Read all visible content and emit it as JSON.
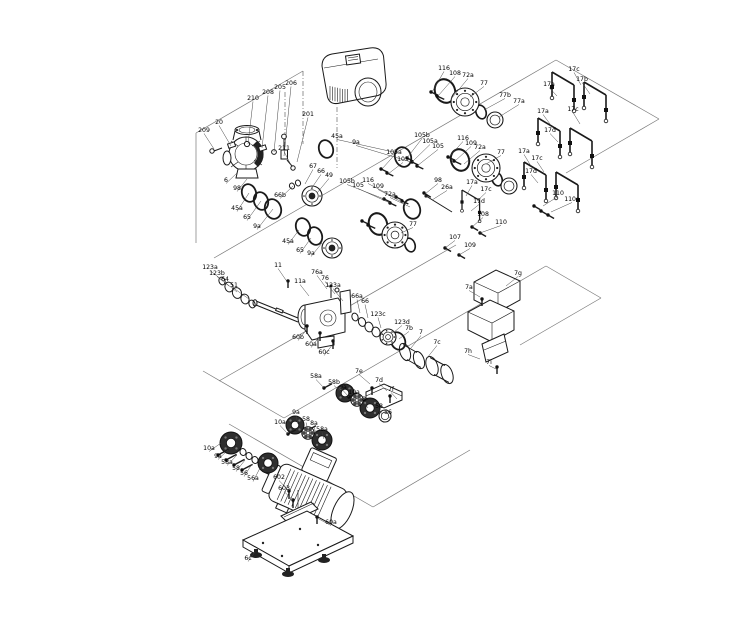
{
  "diagram": {
    "background": "#ffffff",
    "line_color": "#1a1a1a",
    "label_color": "#000000",
    "callouts": [
      {
        "label": "209",
        "x": 204,
        "y": 132,
        "px": 214,
        "py": 149
      },
      {
        "label": "20",
        "x": 219,
        "y": 124,
        "px": 231,
        "py": 146
      },
      {
        "label": "210",
        "x": 253,
        "y": 100,
        "px": 248,
        "py": 144
      },
      {
        "label": "208",
        "x": 268,
        "y": 94,
        "px": 262,
        "py": 148
      },
      {
        "label": "205",
        "x": 280,
        "y": 89,
        "px": 274,
        "py": 152
      },
      {
        "label": "206",
        "x": 291,
        "y": 85,
        "px": 284,
        "py": 156
      },
      {
        "label": "201",
        "x": 308,
        "y": 116,
        "px": 297,
        "py": 162
      },
      {
        "label": "211",
        "x": 284,
        "y": 150,
        "px": 292,
        "py": 167
      },
      {
        "label": "6",
        "x": 226,
        "y": 182,
        "px": 237,
        "py": 173
      },
      {
        "label": "98",
        "x": 237,
        "y": 190,
        "px": 247,
        "py": 179
      },
      {
        "label": "66b",
        "x": 280,
        "y": 197,
        "px": 293,
        "py": 186
      },
      {
        "label": "45a",
        "x": 237,
        "y": 210,
        "px": 249,
        "py": 193
      },
      {
        "label": "65",
        "x": 247,
        "y": 219,
        "px": 261,
        "py": 201
      },
      {
        "label": "9a",
        "x": 257,
        "y": 228,
        "px": 273,
        "py": 209
      },
      {
        "label": "67",
        "x": 313,
        "y": 168,
        "px": 305,
        "py": 184
      },
      {
        "label": "66",
        "x": 321,
        "y": 173,
        "px": 311,
        "py": 189
      },
      {
        "label": "49",
        "x": 329,
        "y": 177,
        "px": 317,
        "py": 193
      },
      {
        "label": "45a",
        "x": 337,
        "y": 138,
        "px": 398,
        "py": 153
      },
      {
        "label": "9a",
        "x": 356,
        "y": 144,
        "px": 411,
        "py": 162
      },
      {
        "label": "116",
        "x": 444,
        "y": 70,
        "px": 432,
        "py": 92
      },
      {
        "label": "108",
        "x": 455,
        "y": 75,
        "px": 438,
        "py": 96
      },
      {
        "label": "72a",
        "x": 468,
        "y": 77,
        "px": 451,
        "py": 99
      },
      {
        "label": "77",
        "x": 484,
        "y": 85,
        "px": 470,
        "py": 97
      },
      {
        "label": "77b",
        "x": 505,
        "y": 97,
        "px": 484,
        "py": 110
      },
      {
        "label": "77a",
        "x": 519,
        "y": 103,
        "px": 499,
        "py": 117
      },
      {
        "label": "17c",
        "x": 574,
        "y": 71,
        "px": 581,
        "py": 85
      },
      {
        "label": "17b",
        "x": 582,
        "y": 81,
        "px": 590,
        "py": 94
      },
      {
        "label": "17a",
        "x": 549,
        "y": 86,
        "px": 557,
        "py": 96
      },
      {
        "label": "105b",
        "x": 422,
        "y": 137,
        "px": 407,
        "py": 158
      },
      {
        "label": "105a",
        "x": 430,
        "y": 143,
        "px": 412,
        "py": 162
      },
      {
        "label": "105",
        "x": 438,
        "y": 148,
        "px": 417,
        "py": 166
      },
      {
        "label": "105a",
        "x": 394,
        "y": 154,
        "px": 382,
        "py": 169
      },
      {
        "label": "105",
        "x": 403,
        "y": 161,
        "px": 388,
        "py": 174
      },
      {
        "label": "116",
        "x": 463,
        "y": 140,
        "px": 449,
        "py": 157
      },
      {
        "label": "109",
        "x": 471,
        "y": 145,
        "px": 455,
        "py": 161
      },
      {
        "label": "72a",
        "x": 480,
        "y": 149,
        "px": 464,
        "py": 164
      },
      {
        "label": "77",
        "x": 501,
        "y": 154,
        "px": 486,
        "py": 164
      },
      {
        "label": "17a",
        "x": 543,
        "y": 113,
        "px": 550,
        "py": 124
      },
      {
        "label": "17c",
        "x": 573,
        "y": 111,
        "px": 580,
        "py": 124
      },
      {
        "label": "17d",
        "x": 550,
        "y": 132,
        "px": 558,
        "py": 142
      },
      {
        "label": "110",
        "x": 558,
        "y": 195,
        "px": 543,
        "py": 206
      },
      {
        "label": "110a",
        "x": 572,
        "y": 201,
        "px": 551,
        "py": 212
      },
      {
        "label": "45a",
        "x": 288,
        "y": 243,
        "px": 299,
        "py": 230
      },
      {
        "label": "65",
        "x": 300,
        "y": 252,
        "px": 311,
        "py": 238
      },
      {
        "label": "9a",
        "x": 311,
        "y": 255,
        "px": 322,
        "py": 243
      },
      {
        "label": "105b",
        "x": 347,
        "y": 183,
        "px": 384,
        "py": 199
      },
      {
        "label": "105",
        "x": 358,
        "y": 187,
        "px": 390,
        "py": 203
      },
      {
        "label": "116",
        "x": 368,
        "y": 182,
        "px": 396,
        "py": 198
      },
      {
        "label": "109",
        "x": 378,
        "y": 188,
        "px": 402,
        "py": 202
      },
      {
        "label": "72a",
        "x": 390,
        "y": 196,
        "px": 410,
        "py": 207
      },
      {
        "label": "77",
        "x": 413,
        "y": 226,
        "px": 401,
        "py": 233
      },
      {
        "label": "98",
        "x": 438,
        "y": 182,
        "px": 425,
        "py": 194
      },
      {
        "label": "26a",
        "x": 447,
        "y": 189,
        "px": 432,
        "py": 200
      },
      {
        "label": "17a",
        "x": 472,
        "y": 184,
        "px": 466,
        "py": 196
      },
      {
        "label": "17c",
        "x": 486,
        "y": 191,
        "px": 477,
        "py": 201
      },
      {
        "label": "17d",
        "x": 479,
        "y": 203,
        "px": 471,
        "py": 211
      },
      {
        "label": "17a",
        "x": 524,
        "y": 153,
        "px": 531,
        "py": 166
      },
      {
        "label": "17c",
        "x": 537,
        "y": 160,
        "px": 544,
        "py": 172
      },
      {
        "label": "17d",
        "x": 531,
        "y": 173,
        "px": 538,
        "py": 183
      },
      {
        "label": "108",
        "x": 483,
        "y": 216,
        "px": 472,
        "py": 227
      },
      {
        "label": "110",
        "x": 501,
        "y": 224,
        "px": 480,
        "py": 233
      },
      {
        "label": "107",
        "x": 455,
        "y": 239,
        "px": 445,
        "py": 248
      },
      {
        "label": "109",
        "x": 470,
        "y": 247,
        "px": 459,
        "py": 255
      },
      {
        "label": "123a",
        "x": 210,
        "y": 269,
        "px": 222,
        "py": 280
      },
      {
        "label": "123b",
        "x": 217,
        "y": 275,
        "px": 229,
        "py": 286
      },
      {
        "label": "64",
        "x": 225,
        "y": 281,
        "px": 237,
        "py": 292
      },
      {
        "label": "51",
        "x": 234,
        "y": 287,
        "px": 249,
        "py": 299
      },
      {
        "label": "11",
        "x": 278,
        "y": 267,
        "px": 288,
        "py": 283
      },
      {
        "label": "11a",
        "x": 300,
        "y": 283,
        "px": 309,
        "py": 296
      },
      {
        "label": "76a",
        "x": 317,
        "y": 274,
        "px": 327,
        "py": 289
      },
      {
        "label": "76",
        "x": 325,
        "y": 280,
        "px": 335,
        "py": 294
      },
      {
        "label": "123a",
        "x": 333,
        "y": 287,
        "px": 343,
        "py": 301
      },
      {
        "label": "66a",
        "x": 357,
        "y": 298,
        "px": 360,
        "py": 313
      },
      {
        "label": "66",
        "x": 365,
        "y": 303,
        "px": 368,
        "py": 318
      },
      {
        "label": "123c",
        "x": 378,
        "y": 316,
        "px": 381,
        "py": 328
      },
      {
        "label": "123d",
        "x": 402,
        "y": 324,
        "px": 393,
        "py": 333
      },
      {
        "label": "7b",
        "x": 409,
        "y": 330,
        "px": 399,
        "py": 339
      },
      {
        "label": "7",
        "x": 421,
        "y": 334,
        "px": 411,
        "py": 348
      },
      {
        "label": "7c",
        "x": 437,
        "y": 344,
        "px": 427,
        "py": 358
      },
      {
        "label": "60b",
        "x": 298,
        "y": 339,
        "px": 307,
        "py": 329
      },
      {
        "label": "60a",
        "x": 311,
        "y": 346,
        "px": 320,
        "py": 336
      },
      {
        "label": "60c",
        "x": 324,
        "y": 354,
        "px": 333,
        "py": 344
      },
      {
        "label": "7e",
        "x": 359,
        "y": 373,
        "px": 370,
        "py": 384
      },
      {
        "label": "7d",
        "x": 379,
        "y": 382,
        "px": 387,
        "py": 391
      },
      {
        "label": "7f",
        "x": 391,
        "y": 391,
        "px": 397,
        "py": 399
      },
      {
        "label": "7g",
        "x": 518,
        "y": 275,
        "px": 506,
        "py": 286
      },
      {
        "label": "7a",
        "x": 469,
        "y": 289,
        "px": 480,
        "py": 297
      },
      {
        "label": "7h",
        "x": 468,
        "y": 353,
        "px": 480,
        "py": 359
      },
      {
        "label": "7i",
        "x": 489,
        "y": 364,
        "px": 496,
        "py": 369
      },
      {
        "label": "10a",
        "x": 209,
        "y": 450,
        "px": 221,
        "py": 443
      },
      {
        "label": "9a",
        "x": 218,
        "y": 458,
        "px": 228,
        "py": 450
      },
      {
        "label": "58a",
        "x": 227,
        "y": 464,
        "px": 237,
        "py": 455
      },
      {
        "label": "58",
        "x": 236,
        "y": 470,
        "px": 245,
        "py": 460
      },
      {
        "label": "56",
        "x": 244,
        "y": 475,
        "px": 252,
        "py": 464
      },
      {
        "label": "56a",
        "x": 253,
        "y": 480,
        "px": 260,
        "py": 468
      },
      {
        "label": "10a",
        "x": 280,
        "y": 424,
        "px": 288,
        "py": 434
      },
      {
        "label": "9a",
        "x": 296,
        "y": 414,
        "px": 298,
        "py": 424
      },
      {
        "label": "58",
        "x": 306,
        "y": 421,
        "px": 308,
        "py": 430
      },
      {
        "label": "8a",
        "x": 314,
        "y": 425,
        "px": 316,
        "py": 434
      },
      {
        "label": "58a",
        "x": 322,
        "y": 431,
        "px": 324,
        "py": 439
      },
      {
        "label": "58a",
        "x": 316,
        "y": 378,
        "px": 324,
        "py": 388
      },
      {
        "label": "58b",
        "x": 334,
        "y": 384,
        "px": 341,
        "py": 392
      },
      {
        "label": "9a",
        "x": 343,
        "y": 389,
        "px": 349,
        "py": 397
      },
      {
        "label": "10a",
        "x": 354,
        "y": 394,
        "px": 360,
        "py": 403
      },
      {
        "label": "8",
        "x": 364,
        "y": 401,
        "px": 368,
        "py": 408
      },
      {
        "label": "58",
        "x": 379,
        "y": 408,
        "px": 382,
        "py": 414
      },
      {
        "label": "56",
        "x": 388,
        "y": 414,
        "px": 391,
        "py": 419
      },
      {
        "label": "602",
        "x": 279,
        "y": 479,
        "px": 289,
        "py": 491
      },
      {
        "label": "603",
        "x": 284,
        "y": 490,
        "px": 293,
        "py": 500
      },
      {
        "label": "60a",
        "x": 331,
        "y": 524,
        "px": 317,
        "py": 518
      },
      {
        "label": "6c",
        "x": 248,
        "y": 560,
        "px": 255,
        "py": 552
      }
    ]
  }
}
